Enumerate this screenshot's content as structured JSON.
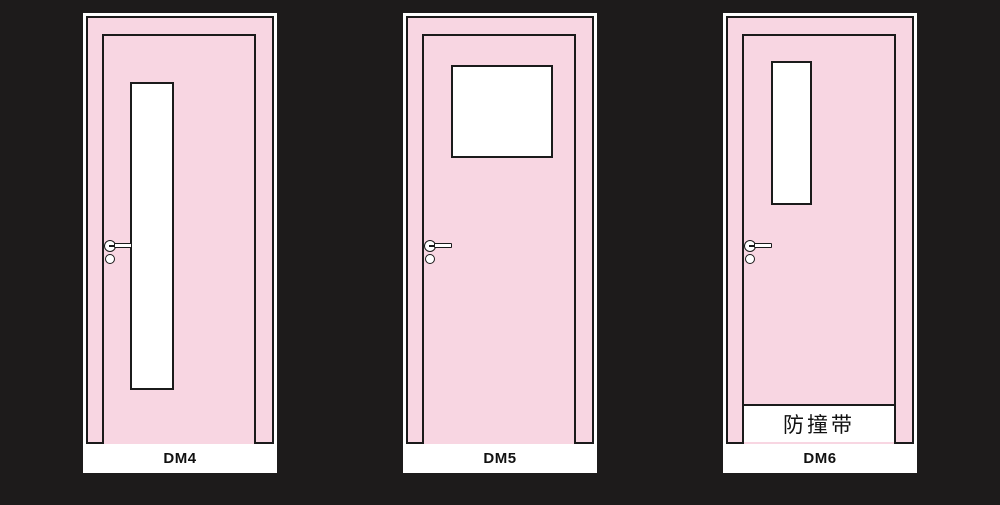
{
  "canvas": {
    "width": 1000,
    "height": 505,
    "background": "#1d1b1b"
  },
  "palette": {
    "door_fill": "#f8d6e2",
    "outline": "#1b1b1b",
    "card": "#ffffff",
    "label_text": "#111111"
  },
  "doors": [
    {
      "label": "DM4",
      "window": {
        "left": 47,
        "top": 69,
        "width": 44,
        "height": 308
      },
      "handle": true,
      "bumper_strip": null
    },
    {
      "label": "DM5",
      "window": {
        "left": 48,
        "top": 52,
        "width": 102,
        "height": 93
      },
      "handle": true,
      "bumper_strip": null
    },
    {
      "label": "DM6",
      "window": {
        "left": 48,
        "top": 48,
        "width": 41,
        "height": 144
      },
      "handle": true,
      "bumper_strip": {
        "label": "防撞带"
      }
    }
  ]
}
